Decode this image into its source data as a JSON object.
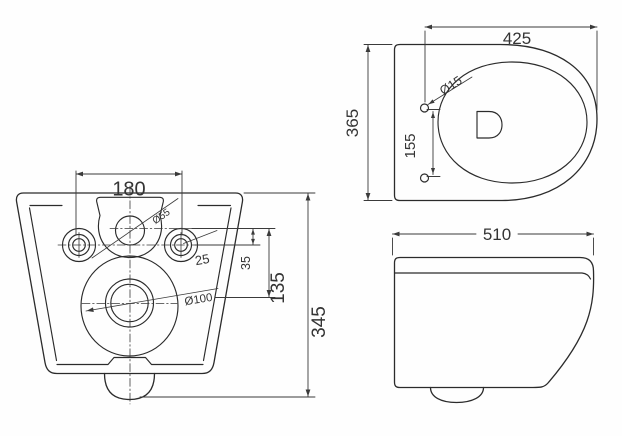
{
  "drawing": {
    "type": "technical-dimension-drawing",
    "subject": "wall-hung toilet, three orthographic views",
    "line_color": "#2b2b2b",
    "background": "#fefefe",
    "views": {
      "rear": {
        "name": "rear (wall fixing) view",
        "dimensions": {
          "fixing_hole_spacing": "180",
          "overall_height": "345",
          "outlet_center_offset": "135",
          "inlet_to_hole_offset": "35",
          "hole_offset": "25",
          "outlet_diameter": "Ø100",
          "inlet_diameter": "Ø55"
        }
      },
      "top": {
        "name": "top (plan) view",
        "dimensions": {
          "depth_to_hinge": "425",
          "overall_width": "365",
          "hinge_hole_spacing": "155",
          "hinge_hole_diameter": "Ø15"
        }
      },
      "side": {
        "name": "side view",
        "dimensions": {
          "overall_depth": "510"
        }
      }
    }
  }
}
